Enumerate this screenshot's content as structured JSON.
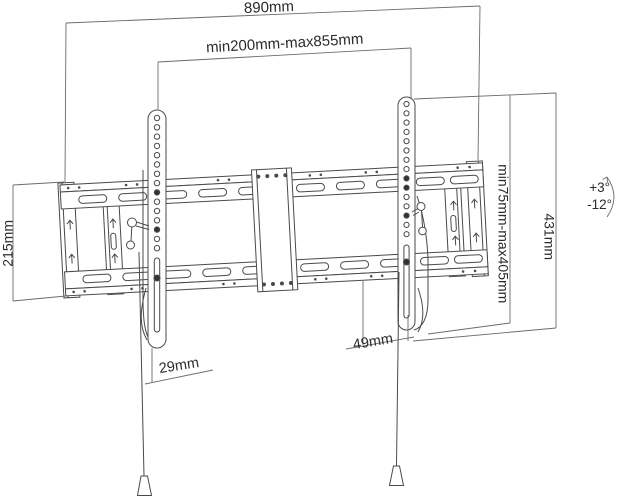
{
  "dimensions": {
    "overall_width": "890mm",
    "horizontal_range": "min200mm-max855mm",
    "wall_plate_height": "215mm",
    "vertical_range": "min75mm-max405mm",
    "bracket_height": "431mm",
    "bottom_depth_left": "29mm",
    "bottom_depth_right": "49mm"
  },
  "tilt": {
    "up": "+3°",
    "down": "-12°"
  },
  "colors": {
    "line": "#4a4a4a",
    "dimension_line": "#6b6b6b",
    "text": "#2b2b2b",
    "background": "#ffffff"
  }
}
